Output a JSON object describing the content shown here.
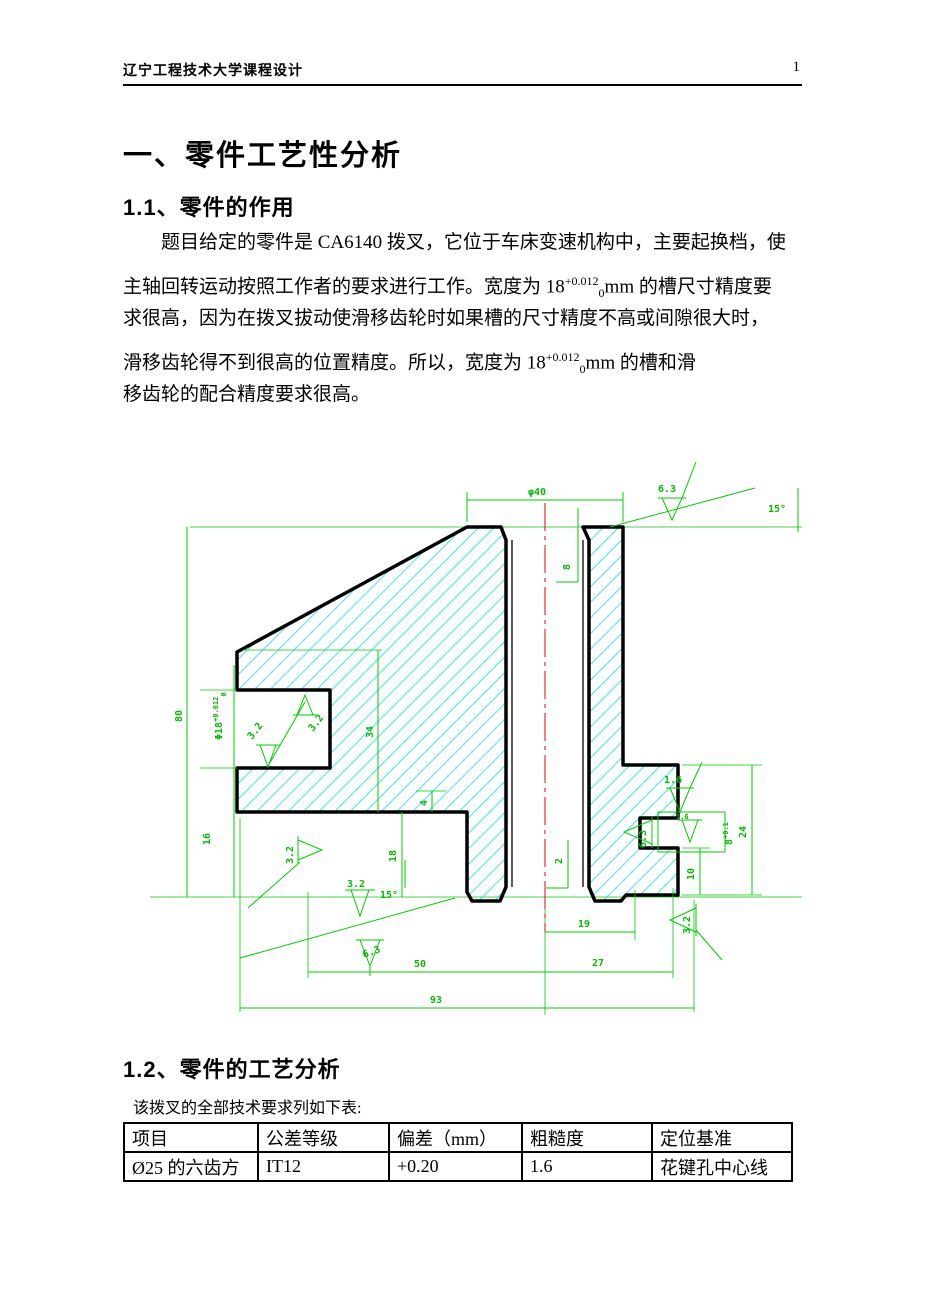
{
  "header": {
    "title": "辽宁工程技术大学课程设计",
    "page_number": "1"
  },
  "sections": {
    "main_title": "一、零件工艺性分析",
    "s11": {
      "heading": "1.1、零件的作用",
      "lines": [
        {
          "t": "题目给定的零件是 CA6140 拨叉，它位于车床变速机构中，主要起换档，使"
        },
        {
          "pre": "主轴回转运动按照工作者的要求进行工作。宽度为 18",
          "sup": "+0.012",
          "sub": "0",
          "post": "mm 的槽尺寸精度要"
        },
        {
          "t": "求很高，因为在拨叉拔动使滑移齿轮时如果槽的尺寸精度不高或间隙很大时，"
        },
        {
          "pre": "滑移齿轮得不到很高的位置精度。所以，宽度为 18",
          "sup": "+0.012",
          "sub": "0",
          "post": "mm 的槽和滑"
        },
        {
          "t": "移齿轮的配合精度要求很高。"
        }
      ]
    },
    "s12": {
      "heading": "1.2、零件的工艺分析",
      "intro": "该拨叉的全部技术要求列如下表:"
    }
  },
  "drawing": {
    "colors": {
      "dimension": "#00cc00",
      "hatch": "#00e0e0",
      "outline": "#000000",
      "centerline": "#e30000"
    },
    "labels": {
      "phi40": "φ40",
      "rough_top": "6.3",
      "angle_top": "15°",
      "depth8": "8",
      "h80": "80",
      "slot_phi": "Φ18",
      "slot_sup": "+0.012",
      "slot_sub": "0",
      "h16": "16",
      "h34": "34",
      "h4": "4",
      "h18": "18",
      "rough_slot_top": "3.2",
      "rough_slot_bottom": "3.2",
      "rough_side": "3.2",
      "rough_mid": "3.2",
      "rough_bottom": "6.3",
      "angle_bottom": "15°",
      "depth2": "2",
      "w19": "19",
      "w50": "50",
      "w27": "27",
      "w93": "93",
      "rough_lug": "1.6",
      "rough_notch": "1.6",
      "rough_notch_side": "6.3",
      "notch8": "8",
      "notch8_tol": "+0.1",
      "h10": "10",
      "h24": "24",
      "rough_right": "3.2"
    }
  },
  "table": {
    "headers": [
      "项目",
      "公差等级",
      "偏差（mm）",
      "粗糙度",
      "定位基准"
    ],
    "rows": [
      [
        "Ø25 的六齿方",
        "IT12",
        "+0.20",
        "1.6",
        "花键孔中心线"
      ]
    ]
  }
}
